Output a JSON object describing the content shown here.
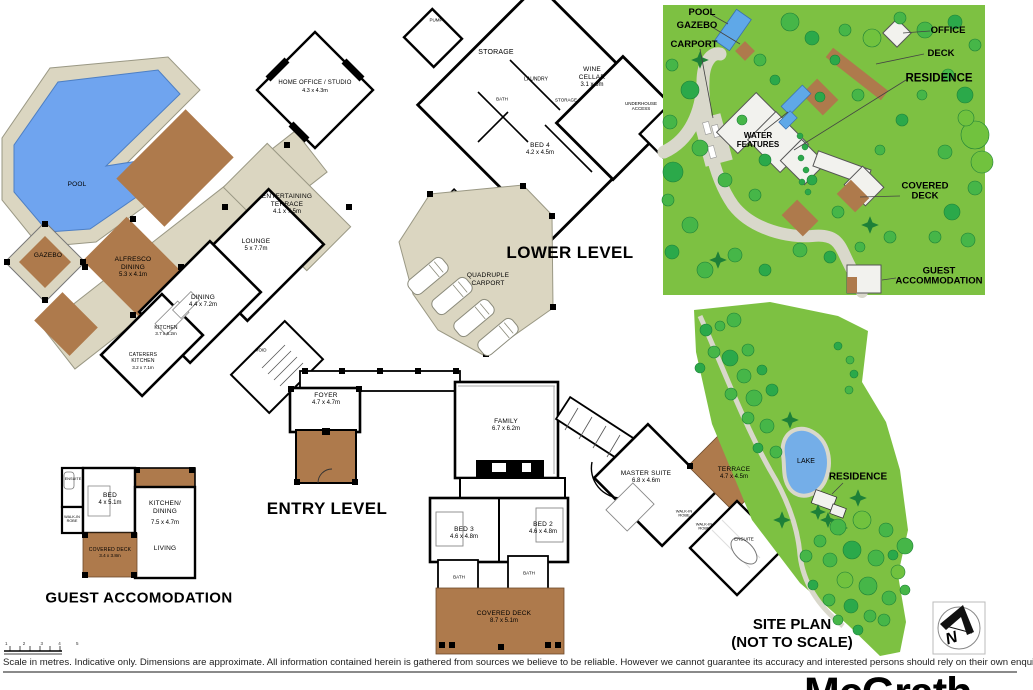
{
  "upper_level": {
    "pool": "POOL",
    "gazebo": "GAZEBO",
    "alfresco": {
      "name": "ALFRESCO\nDINING",
      "dims": "5.3 x 4.1m"
    },
    "entertaining_terrace": {
      "name": "ENTERTAINING\nTERRACE",
      "dims": "4.1 x 7.5m"
    },
    "lounge": {
      "name": "LOUNGE",
      "dims": "5 x 7.7m"
    },
    "dining": {
      "name": "DINING",
      "dims": "4.4 x 7.2m"
    },
    "kitchen": {
      "name": "KITCHEN",
      "dims": "3.7 x 6.2m"
    },
    "caterers_kitchen": {
      "name": "CATERERS\nKITCHEN",
      "dims": "3.2 x 7.1m"
    },
    "home_office": {
      "name": "HOME OFFICE / STUDIO",
      "dims": "4.3 x 4.3m"
    }
  },
  "lower_level": {
    "title": "LOWER LEVEL",
    "pump": "PUMP",
    "storage": "STORAGE",
    "laundry": "LAUNDRY",
    "bath": "BATH",
    "storage_small": "STORAGE",
    "wine_cellar": {
      "name": "WINE\nCELLAR",
      "dims": "3.1 x 6m"
    },
    "bed4": {
      "name": "BED 4",
      "dims": "4.2 x 4.5m"
    },
    "underhouse_access": "UNDERHOUSE\nACCESS",
    "carport": {
      "name": "QUADRUPLE\nCARPORT"
    }
  },
  "entry_level": {
    "title": "ENTRY LEVEL",
    "void": "VOID",
    "foyer": {
      "name": "FOYER",
      "dims": "4.7 x 4.7m"
    },
    "family": {
      "name": "FAMILY",
      "dims": "6.7 x 6.2m"
    },
    "master_suite": {
      "name": "MASTER SUITE",
      "dims": "6.8 x 4.6m"
    },
    "terrace": {
      "name": "TERRACE",
      "dims": "4.7 x 4.5m"
    },
    "walk_in_robe1": "WALK-IN\nROBE",
    "walk_in_robe2": "WALK-IN\nROBE",
    "ensuite": "ENSUITE",
    "bed3": {
      "name": "BED 3",
      "dims": "4.6 x 4.8m"
    },
    "bed2": {
      "name": "BED 2",
      "dims": "4.6 x 4.8m"
    },
    "bath1": "BATH",
    "bath2": "BATH",
    "covered_deck": {
      "name": "COVERED DECK",
      "dims": "8.7 x 5.1m"
    }
  },
  "guest_accommodation": {
    "title": "GUEST ACCOMODATION",
    "ensuite": "ENSUITE",
    "walk_in_robe": "WALK-IN\nROBE",
    "bed": {
      "name": "BED",
      "dims": "4 x 5.1m"
    },
    "kitchen_dining": {
      "name": "KITCHEN/\nDINING",
      "dims": "7.5 x 4.7m"
    },
    "living": "LIVING",
    "covered_deck": {
      "name": "COVERED DECK",
      "dims": "3.4 x 3.8m"
    }
  },
  "site_detail": {
    "pool": "POOL",
    "gazebo": "GAZEBO",
    "carport": "CARPORT",
    "office": "OFFICE",
    "deck": "DECK",
    "residence": "RESIDENCE",
    "water_features": "WATER\nFEATURES",
    "covered_deck": "COVERED\nDECK",
    "guest_accommodation": "GUEST\nACCOMMODATION"
  },
  "site_plan": {
    "title": "SITE PLAN\n(NOT TO SCALE)",
    "lake": "LAKE",
    "residence": "RESIDENCE"
  },
  "footer": {
    "scale_ticks": "1 2 3 4 5",
    "disclaimer": "Scale in metres. Indicative only. Dimensions are approximate. All information contained herein is gathered from sources we believe to be reliable. However we cannot guarantee its accuracy and interested persons should rely on their own enquiries",
    "brand": "McGrath",
    "compass_letter": "N"
  },
  "colors": {
    "deck_brown": "#AE7A4C",
    "surface_beige": "#DBD6C1",
    "pool_blue": "#6FA4EF",
    "site_green": "#7DC142",
    "tree_green_dark": "#2BA94A",
    "path_grey": "#D9D8CB"
  }
}
